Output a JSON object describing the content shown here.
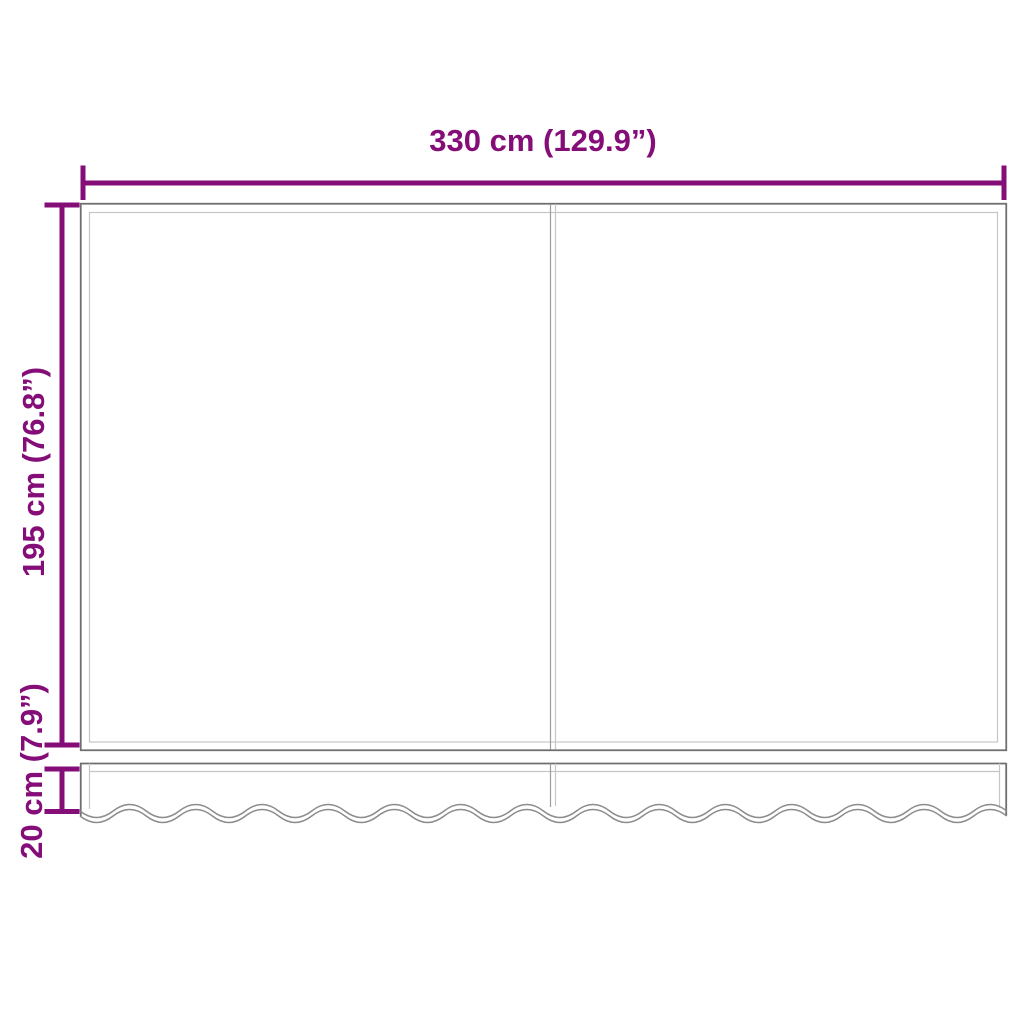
{
  "dimensions": {
    "width": "330 cm (129.9”)",
    "height": "195 cm (76.8”)",
    "valance_height": "20 cm (7.9”)"
  },
  "colors": {
    "background": "#ffffff",
    "dimension": "#840d78",
    "outline": "#6f6f6f",
    "outline_light": "#c6c6c6",
    "seam": "#9c9c9c",
    "wave": "#8c8c8c"
  }
}
